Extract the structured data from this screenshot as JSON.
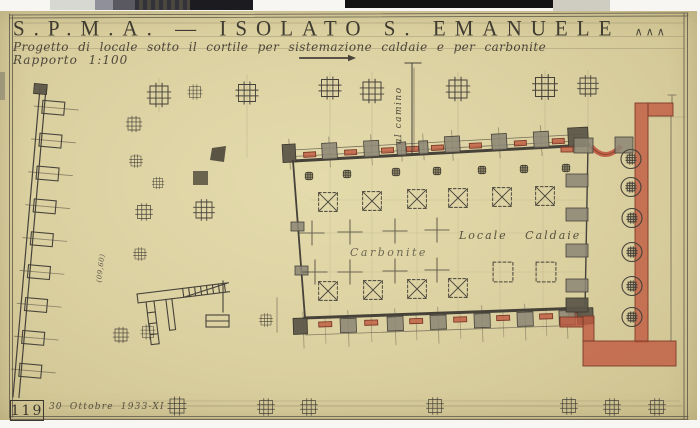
{
  "title_block": {
    "project_code_title": "S.P.M.A. — ISOLATO S. EMANUELE",
    "title_marks": "∧∧∧",
    "subtitle": "Progetto di locale sotto il cortile per sistemazione caldaie e per carbonite",
    "scale_note": "Rapporto 1:100"
  },
  "plan_labels": {
    "coal_room": "Carbonite",
    "boiler_room": "Locale Caldaie",
    "flue_note": "al camino",
    "dimension_note": "(09,60)"
  },
  "footer": {
    "sheet_number": "119",
    "date_note": "30 Ottobre 1933-XI"
  },
  "colors": {
    "paper": "#dacf9f",
    "ink": "#46423a",
    "masonry_red": "#c05a41",
    "pier_gray": "#8d8775"
  }
}
